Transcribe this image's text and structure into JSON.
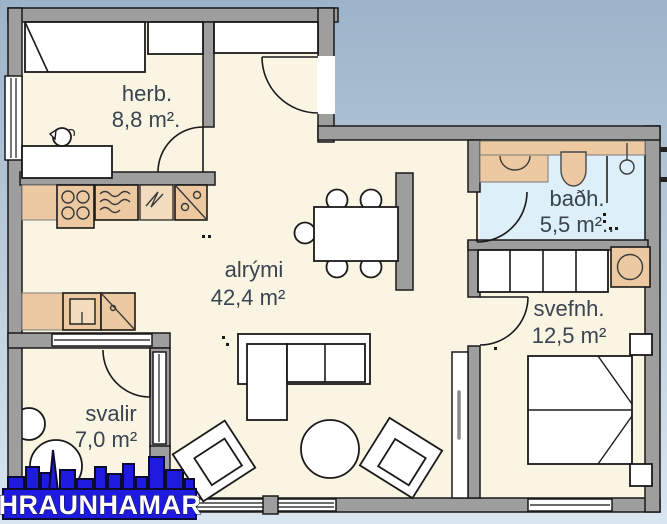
{
  "plan": {
    "type": "apartment-floor-plan",
    "rooms": [
      {
        "id": "herb",
        "name": "herb.",
        "area": "8,8 m²."
      },
      {
        "id": "alrymi",
        "name": "alrými",
        "area": "42,4 m²"
      },
      {
        "id": "badh",
        "name": "baðh.",
        "area": "5,5 m².."
      },
      {
        "id": "svefnh",
        "name": "svefnh.",
        "area": "12,5 m²"
      },
      {
        "id": "svalir",
        "name": "svalir",
        "area": "7,0 m²"
      }
    ]
  },
  "logo": {
    "text": "HRAUNHAMAR"
  },
  "colors": {
    "sky_top": "#9cb3c9",
    "sky_bottom": "#d9e6f0",
    "wall": "#9e9e9e",
    "line": "#1a1a1a",
    "floor": "#faf4e3",
    "bath_floor": "#ddeff8",
    "furniture_tan": "#ecc9a1",
    "furniture_tan_light": "#f3dcbd",
    "label": "#3a4350",
    "logo_blue": "#1f1ae0",
    "logo_text": "#ffffff"
  }
}
